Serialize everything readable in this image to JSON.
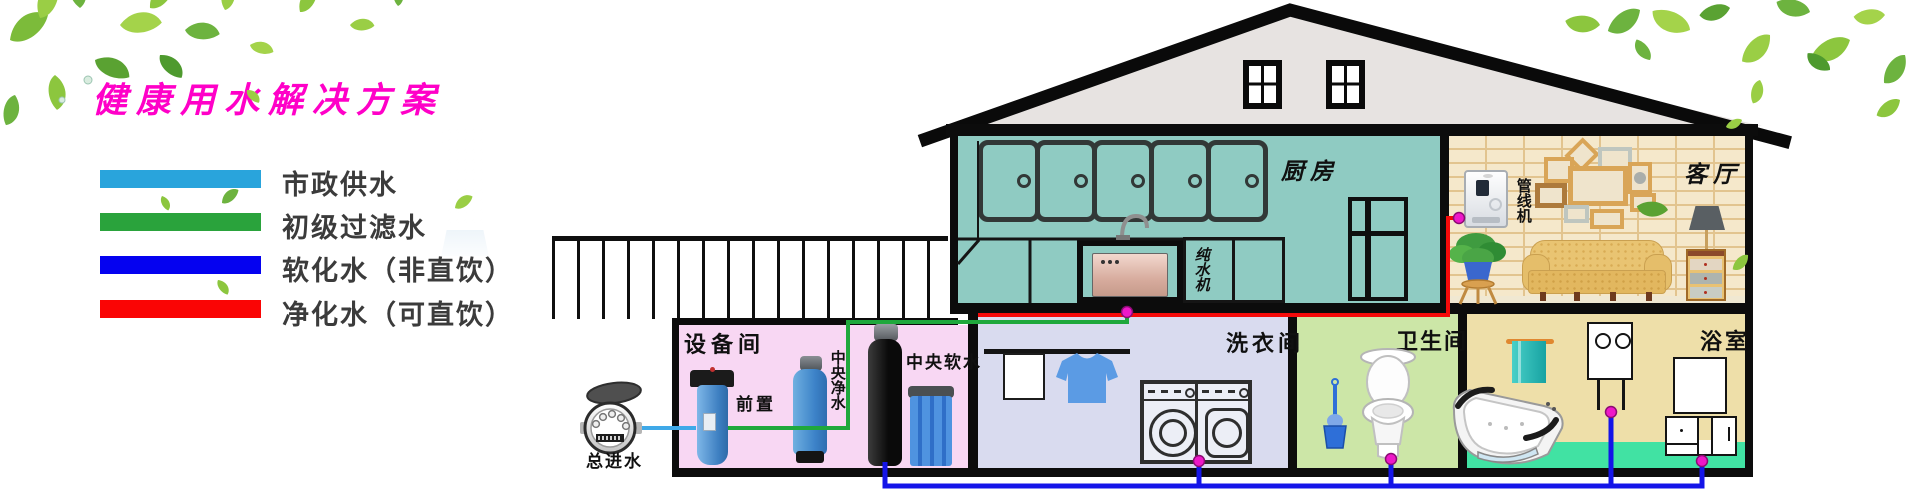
{
  "title": {
    "text": "健康用水解决方案",
    "color": "#ff00c8"
  },
  "legend": {
    "items": [
      {
        "label": "市政供水",
        "color": "#29a4dc"
      },
      {
        "label": "初级过滤水",
        "color": "#2aa33c"
      },
      {
        "label": "软化水（非直饮）",
        "color": "#0502f0"
      },
      {
        "label": "净化水（可直饮）",
        "color": "#fa0505"
      }
    ]
  },
  "water_meter": {
    "label": "总进水"
  },
  "rooms": {
    "kitchen": {
      "label": "厨房"
    },
    "living_room": {
      "label": "客厅"
    },
    "equipment_room": {
      "label": "设备间"
    },
    "laundry_room": {
      "label": "洗衣间"
    },
    "toilet_room": {
      "label": "卫生间"
    },
    "bathroom": {
      "label": "浴室"
    }
  },
  "devices": {
    "pure_water_machine": "纯水机",
    "pipeline_machine": "管线机",
    "prefilter": "前置",
    "central_purifier": "中央净水",
    "central_softener": "中央软水"
  },
  "pipe_colors": {
    "municipal": "#3fa9e8",
    "filtered": "#1fa83c",
    "softened": "#1414e8",
    "purified": "#f50a0a",
    "junction_dot": "#ee18c8"
  }
}
